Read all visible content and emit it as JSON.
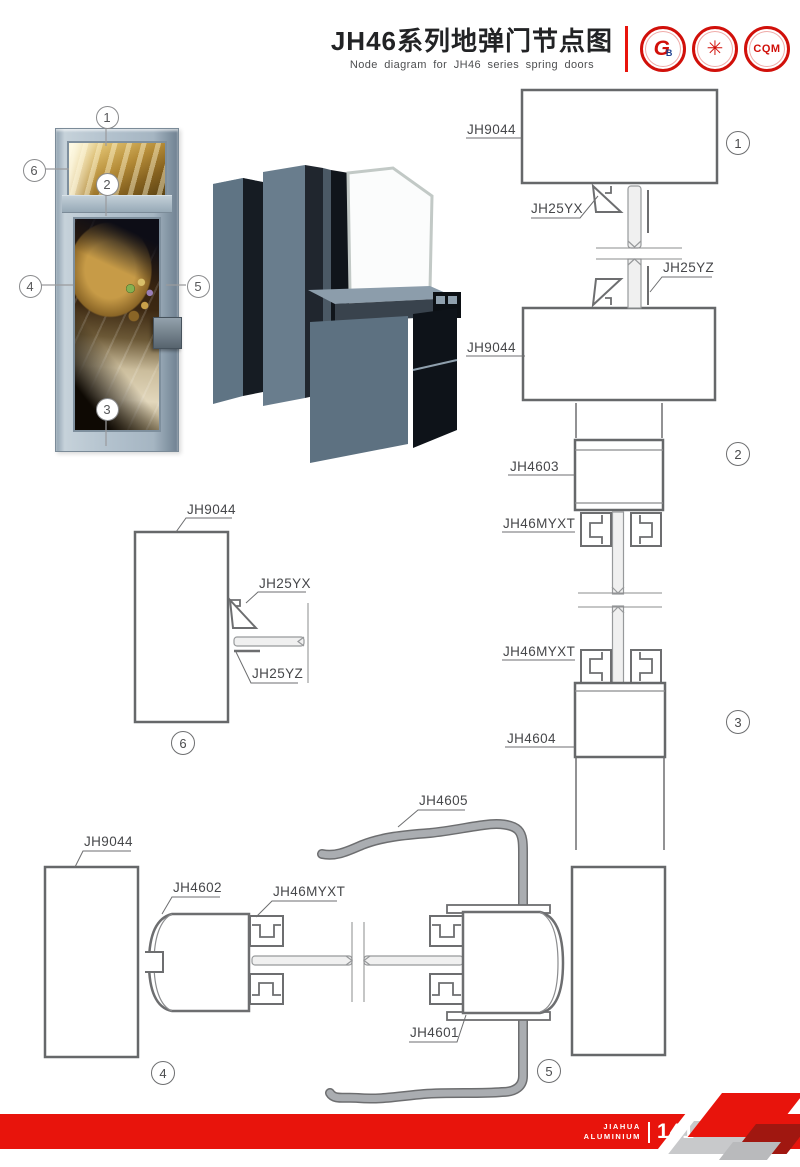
{
  "header": {
    "title_zh": "JH46系列地弹门节点图",
    "title_en": "Node diagram for JH46 series spring doors",
    "accent_red": "#e8140c",
    "logos": {
      "logo1_text": "G",
      "logo1_sub": "B",
      "logo2_text": "✳",
      "logo3_text": "CQM"
    }
  },
  "door_photo": {
    "callouts": {
      "c1": "1",
      "c2": "2",
      "c3": "3",
      "c4": "4",
      "c5": "5",
      "c6": "6"
    }
  },
  "diagrams": {
    "d1": {
      "number": "1",
      "labels": {
        "top_frame": "JH9044",
        "bead_x": "JH25YX",
        "bead_z": "JH25YZ",
        "bottom_frame": "JH9044"
      }
    },
    "d2": {
      "number": "2",
      "labels": {
        "frame": "JH4603",
        "clamp": "JH46MYXT"
      }
    },
    "d3": {
      "number": "3",
      "labels": {
        "clamp": "JH46MYXT",
        "sill": "JH4604"
      }
    },
    "d4": {
      "number": "4",
      "labels": {
        "frame": "JH9044",
        "stile": "JH4602",
        "clamp": "JH46MYXT"
      }
    },
    "d5": {
      "number": "5",
      "labels": {
        "cover": "JH4605",
        "stile": "JH4601"
      }
    },
    "d6": {
      "number": "6",
      "labels": {
        "frame": "JH9044",
        "bead_x": "JH25YX",
        "bead_z": "JH25YZ"
      }
    }
  },
  "footer": {
    "brand_line1": "JIAHUA",
    "brand_line2": "ALUMINIUM",
    "page_number": "141",
    "band_color": "#e8140c"
  }
}
